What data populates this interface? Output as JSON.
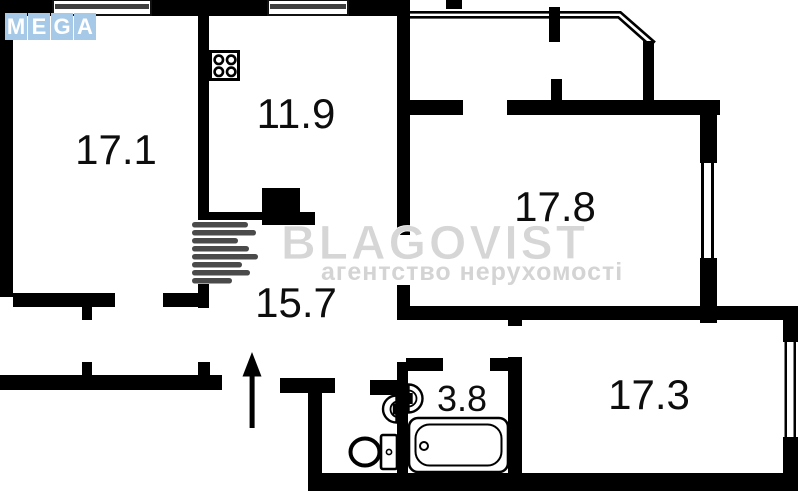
{
  "branding": {
    "logo_letters": [
      "M",
      "E",
      "G",
      "A"
    ],
    "logo_tile_color": "#a7c9e8"
  },
  "watermark": {
    "title": "BLAGOVIST",
    "subtitle": "агентство нерухомості"
  },
  "rooms": [
    {
      "name": "room-17-1",
      "area": "17.1"
    },
    {
      "name": "kitchen",
      "area": "11.9"
    },
    {
      "name": "room-17-8",
      "area": "17.8"
    },
    {
      "name": "hall",
      "area": "15.7"
    },
    {
      "name": "bathroom",
      "area": "3.8"
    },
    {
      "name": "room-17-3",
      "area": "17.3"
    }
  ],
  "colors": {
    "wall": "#000000",
    "watermark_gray": "#4a4a4a",
    "glazing_line": "#3f3f3f"
  }
}
